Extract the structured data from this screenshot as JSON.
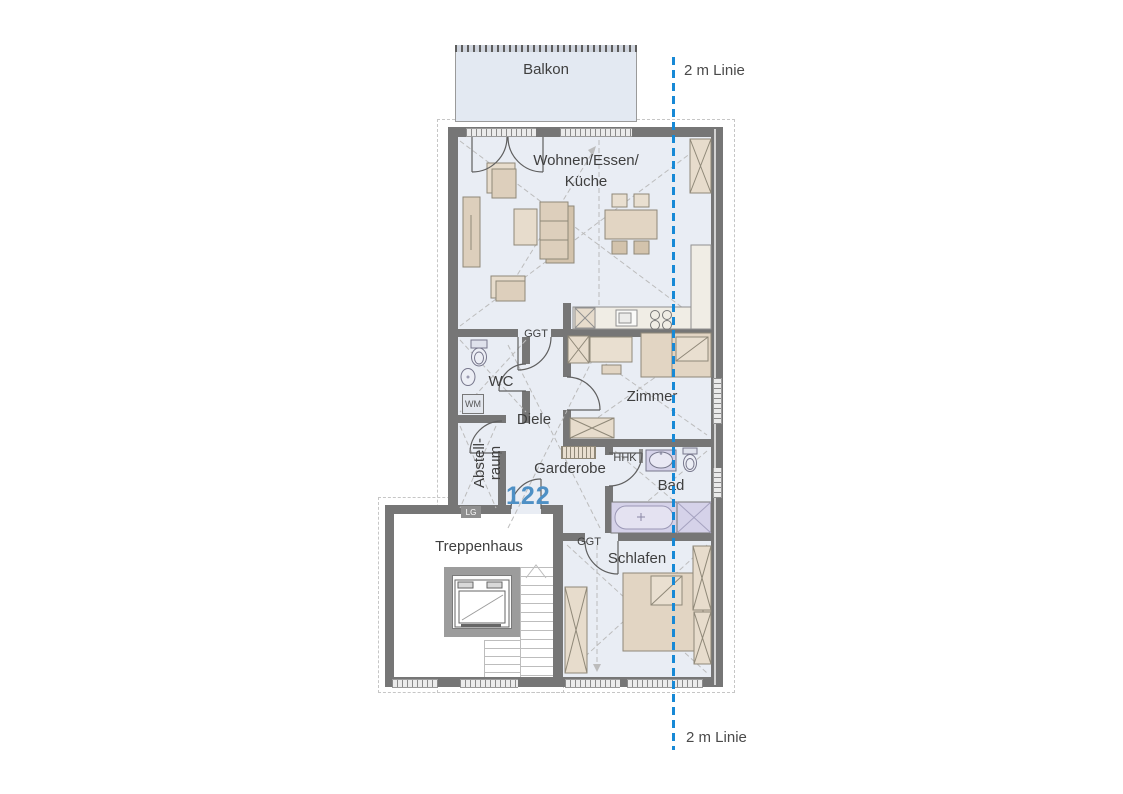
{
  "plan": {
    "unit_number": "122",
    "rooms": {
      "balkon": "Balkon",
      "wohnen_line1": "Wohnen/Essen/",
      "wohnen_line2": "Küche",
      "wc": "WC",
      "diele": "Diele",
      "zimmer": "Zimmer",
      "garderobe": "Garderobe",
      "bad": "Bad",
      "abstell_line1": "Abstell-",
      "abstell_line2": "raum",
      "treppenhaus": "Treppenhaus",
      "schlafen": "Schlafen"
    },
    "markers": {
      "ggt_kitchen": "GGT",
      "ggt_schlafen": "GGT",
      "wm": "WM",
      "lg": "LG",
      "hhk": "HHK"
    },
    "guides": {
      "top_label": "2 m Linie",
      "bottom_label": "2 m Linie",
      "line_color": "#1789d6"
    },
    "colors": {
      "room_fill": "#e9edf4",
      "wall": "#767676",
      "unit_number_color": "#4e90c5",
      "furniture": "#ddcfbc",
      "sanitary": "#d5d2e9"
    }
  }
}
